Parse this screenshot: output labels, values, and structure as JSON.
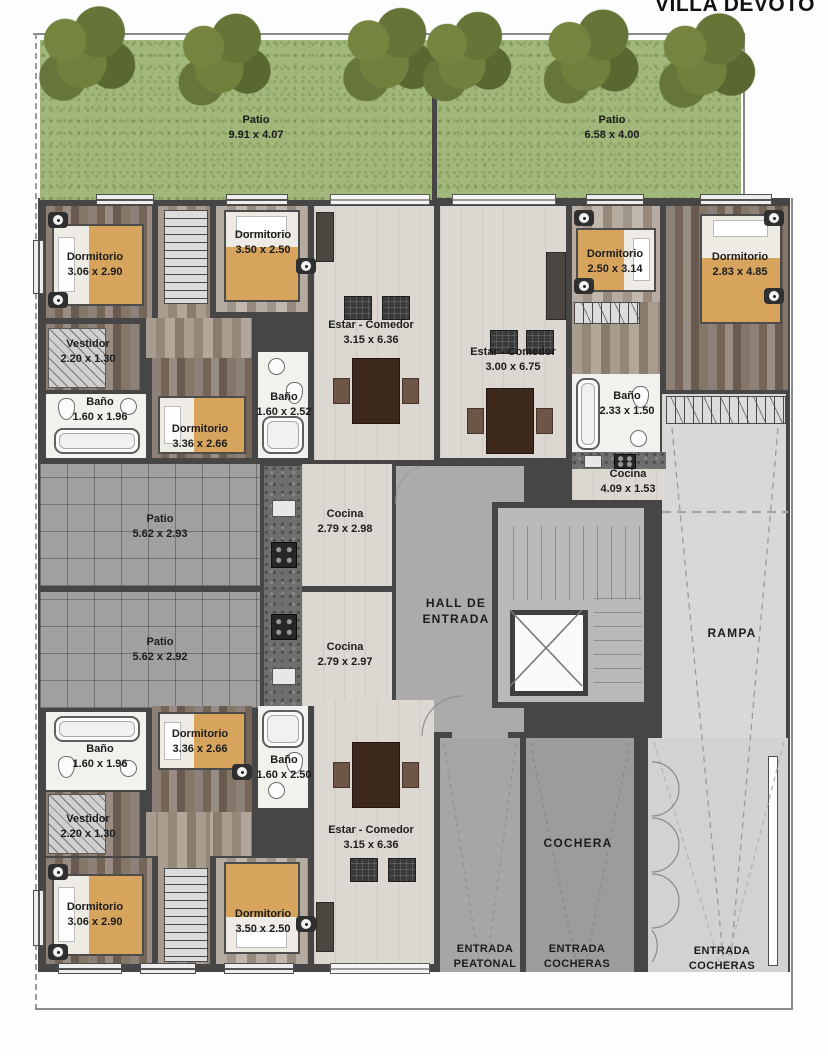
{
  "title": "VILLA DEVOTO",
  "rooms": {
    "patio_tl": {
      "name": "Patio",
      "dims": "9.91 x 4.07"
    },
    "patio_tr": {
      "name": "Patio",
      "dims": "6.58 x 4.00"
    },
    "dorm_tl1": {
      "name": "Dormitorio",
      "dims": "3.06 x 2.90"
    },
    "dorm_tl2": {
      "name": "Dormitorio",
      "dims": "3.50 x 2.50"
    },
    "estar_tl": {
      "name": "Estar - Comedor",
      "dims": "3.15 x 6.36"
    },
    "vestidor_t": {
      "name": "Vestidor",
      "dims": "2.20 x 1.30"
    },
    "bano_tl1": {
      "name": "Baño",
      "dims": "1.60 x 1.96"
    },
    "dorm_tl3": {
      "name": "Dormitorio",
      "dims": "3.36 x 2.66"
    },
    "bano_tl2": {
      "name": "Baño",
      "dims": "1.60 x 2.52"
    },
    "estar_tr": {
      "name": "Estar - Comedor",
      "dims": "3.00 x 6.75"
    },
    "dorm_tr1": {
      "name": "Dormitorio",
      "dims": "2.50 x 3.14"
    },
    "dorm_tr2": {
      "name": "Dormitorio",
      "dims": "2.83 x 4.85"
    },
    "bano_tr": {
      "name": "Baño",
      "dims": "2.33 x 1.50"
    },
    "cocina_tr": {
      "name": "Cocina",
      "dims": "4.09 x 1.53"
    },
    "patio_m1": {
      "name": "Patio",
      "dims": "5.62 x 2.93"
    },
    "cocina_m1": {
      "name": "Cocina",
      "dims": "2.79 x 2.98"
    },
    "patio_m2": {
      "name": "Patio",
      "dims": "5.62 x 2.92"
    },
    "cocina_m2": {
      "name": "Cocina",
      "dims": "2.79 x 2.97"
    },
    "bano_bl1": {
      "name": "Baño",
      "dims": "1.60 x 1.96"
    },
    "dorm_bl1": {
      "name": "Dormitorio",
      "dims": "3.36 x 2.66"
    },
    "bano_bl2": {
      "name": "Baño",
      "dims": "1.60 x 2.50"
    },
    "vestidor_b": {
      "name": "Vestidor",
      "dims": "2.20 x 1.30"
    },
    "estar_bl": {
      "name": "Estar - Comedor",
      "dims": "3.15 x 6.36"
    },
    "dorm_bl2": {
      "name": "Dormitorio",
      "dims": "3.06 x 2.90"
    },
    "dorm_bl3": {
      "name": "Dormitorio",
      "dims": "3.50 x 2.50"
    }
  },
  "areas": {
    "hall": {
      "line1": "HALL DE",
      "line2": "ENTRADA"
    },
    "rampa": "RAMPA",
    "cochera": "COCHERA",
    "entrada_peatonal": {
      "line1": "ENTRADA",
      "line2": "PEATONAL"
    },
    "entrada_cocheras_left": {
      "line1": "ENTRADA",
      "line2": "COCHERAS"
    },
    "entrada_cocheras_right": {
      "line1": "ENTRADA",
      "line2": "COCHERAS"
    }
  },
  "colors": {
    "grass": "#a2b77a",
    "wall": "#464646",
    "accent_bed": "#d6a45d",
    "floor_light": "#dcd8d1",
    "tile": "#a0a0a0",
    "ramp": "#d8d8d8"
  }
}
